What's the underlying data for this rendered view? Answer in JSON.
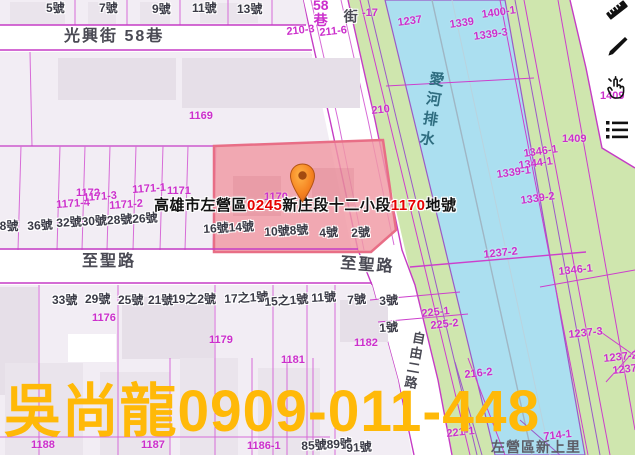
{
  "colors": {
    "parcel_line": "#cc33cc",
    "lot_text": "#cc2fcc",
    "house_text": "#3a3a46",
    "street_text": "#4a4a54",
    "canal_text": "#2f6d80",
    "water": "#abdff0",
    "bank_green": "#cfe6ae",
    "block_fill": "#f2edf4",
    "building_fill": "#e6dfe8",
    "highlight_fill": "#f099a3",
    "highlight_border": "#e86e86",
    "label_red": "#e60000",
    "label_black": "#111111",
    "watermark": "#ffb908",
    "pin_orange": "#f58220"
  },
  "parcel_label": {
    "parts": [
      {
        "text": "高雄市左營區",
        "color": "#111111"
      },
      {
        "text": "0245",
        "color": "#e60000"
      },
      {
        "text": "新庄段十二小段",
        "color": "#111111"
      },
      {
        "text": "1170",
        "color": "#e60000"
      },
      {
        "text": "地號",
        "color": "#111111"
      }
    ]
  },
  "watermark_text": "吳尚龍0909-011-448",
  "canal_name": "愛河排水",
  "admin_area_label": {
    "text": "左營區新上里",
    "x": 491,
    "y": 440
  },
  "street_labels": [
    {
      "text": "光興街 58巷",
      "x": 64,
      "y": 29
    },
    {
      "text": "至聖路",
      "x": 82,
      "y": 254
    },
    {
      "text": "至聖路",
      "x": 341,
      "y": 256,
      "rot": 4
    },
    {
      "text": "街",
      "x": 343,
      "y": 9,
      "cls": "street-v"
    },
    {
      "text": "自由二路",
      "x": 412,
      "y": 330,
      "cls": "street-v",
      "rot": 10,
      "size": 13
    }
  ],
  "lane_label": {
    "lines": [
      "58",
      "巷"
    ],
    "x": 313,
    "y": -2
  },
  "lot_labels": [
    {
      "text": "210-3",
      "x": 286,
      "y": 27,
      "rot": -6
    },
    {
      "text": "211-6",
      "x": 319,
      "y": 28,
      "rot": -6
    },
    {
      "text": "-17",
      "x": 362,
      "y": 8
    },
    {
      "text": "210",
      "x": 371,
      "y": 106,
      "rot": -6
    },
    {
      "text": "1169",
      "x": 189,
      "y": 111
    },
    {
      "text": "1237",
      "x": 397,
      "y": 18,
      "rot": -8
    },
    {
      "text": "1339",
      "x": 449,
      "y": 20,
      "rot": -8
    },
    {
      "text": "1400-1",
      "x": 481,
      "y": 10,
      "rot": -8
    },
    {
      "text": "1339-3",
      "x": 473,
      "y": 32,
      "rot": -8
    },
    {
      "text": "1409",
      "x": 562,
      "y": 134
    },
    {
      "text": "1409",
      "x": 600,
      "y": 91
    },
    {
      "text": "1346-1",
      "x": 523,
      "y": 149,
      "rot": -8
    },
    {
      "text": "1344-1",
      "x": 518,
      "y": 161,
      "rot": -8
    },
    {
      "text": "1339-1",
      "x": 496,
      "y": 170,
      "rot": -8
    },
    {
      "text": "1339-2",
      "x": 520,
      "y": 196,
      "rot": -8
    },
    {
      "text": "1237-2",
      "x": 483,
      "y": 250,
      "rot": -6
    },
    {
      "text": "1346-1",
      "x": 558,
      "y": 267,
      "rot": -6
    },
    {
      "text": "1237-3",
      "x": 568,
      "y": 330,
      "rot": -6
    },
    {
      "text": "1237-2",
      "x": 603,
      "y": 354,
      "rot": -6
    },
    {
      "text": "1237",
      "x": 612,
      "y": 366,
      "rot": -6
    },
    {
      "text": "1172",
      "x": 76,
      "y": 188
    },
    {
      "text": "1171-4",
      "x": 56,
      "y": 200,
      "rot": -4
    },
    {
      "text": "1171-3",
      "x": 83,
      "y": 193,
      "rot": -4
    },
    {
      "text": "1171-2",
      "x": 109,
      "y": 201,
      "rot": -4
    },
    {
      "text": "1171-1",
      "x": 132,
      "y": 185,
      "rot": -4
    },
    {
      "text": "1171",
      "x": 167,
      "y": 186
    },
    {
      "text": "1170",
      "x": 264,
      "y": 192
    },
    {
      "text": "1176",
      "x": 92,
      "y": 313
    },
    {
      "text": "1179",
      "x": 209,
      "y": 335
    },
    {
      "text": "1181",
      "x": 281,
      "y": 355
    },
    {
      "text": "1182",
      "x": 354,
      "y": 338
    },
    {
      "text": "225-1",
      "x": 421,
      "y": 309,
      "rot": -6
    },
    {
      "text": "225-2",
      "x": 430,
      "y": 321,
      "rot": -6
    },
    {
      "text": "221-1",
      "x": 446,
      "y": 429,
      "rot": -6
    },
    {
      "text": "216-2",
      "x": 464,
      "y": 370,
      "rot": -6
    },
    {
      "text": "714-1",
      "x": 543,
      "y": 432,
      "rot": -6
    },
    {
      "text": "1188",
      "x": 31,
      "y": 440
    },
    {
      "text": "1187",
      "x": 141,
      "y": 440
    },
    {
      "text": "1186-1",
      "x": 247,
      "y": 441
    }
  ],
  "house_labels": [
    {
      "text": "5號",
      "x": 46,
      "y": 2
    },
    {
      "text": "7號",
      "x": 99,
      "y": 2
    },
    {
      "text": "9號",
      "x": 152,
      "y": 3
    },
    {
      "text": "11號",
      "x": 192,
      "y": 2
    },
    {
      "text": "13號",
      "x": 237,
      "y": 3
    },
    {
      "text": "38號",
      "x": -7,
      "y": 220
    },
    {
      "text": "36號",
      "x": 27,
      "y": 220,
      "rot": -3
    },
    {
      "text": "32號30號28號26號",
      "x": 56,
      "y": 217,
      "rot": -3
    },
    {
      "text": "16號14號",
      "x": 203,
      "y": 223,
      "rot": -3
    },
    {
      "text": "10號8號",
      "x": 264,
      "y": 226,
      "rot": -3
    },
    {
      "text": "4號",
      "x": 319,
      "y": 227,
      "rot": -3
    },
    {
      "text": "2號",
      "x": 351,
      "y": 227,
      "rot": -3
    },
    {
      "text": "33號",
      "x": 52,
      "y": 294
    },
    {
      "text": "29號",
      "x": 85,
      "y": 293
    },
    {
      "text": "25號",
      "x": 118,
      "y": 294
    },
    {
      "text": "21號",
      "x": 148,
      "y": 294
    },
    {
      "text": "19之2號",
      "x": 172,
      "y": 293
    },
    {
      "text": "17之1號",
      "x": 224,
      "y": 293,
      "rot": -3
    },
    {
      "text": "15之1號",
      "x": 264,
      "y": 296,
      "rot": -4
    },
    {
      "text": "11號",
      "x": 311,
      "y": 292,
      "rot": -3
    },
    {
      "text": "7號",
      "x": 347,
      "y": 294,
      "rot": -3
    },
    {
      "text": "3號",
      "x": 379,
      "y": 295,
      "rot": -3
    },
    {
      "text": "1號",
      "x": 379,
      "y": 322,
      "rot": -3
    },
    {
      "text": "85號89號",
      "x": 301,
      "y": 440,
      "rot": -3
    },
    {
      "text": "91號",
      "x": 346,
      "y": 442,
      "rot": -3
    }
  ],
  "toolbar": {
    "buttons": [
      {
        "name": "ruler-icon"
      },
      {
        "name": "pencil-icon"
      },
      {
        "name": "select-hand-icon"
      },
      {
        "name": "list-icon"
      }
    ]
  }
}
